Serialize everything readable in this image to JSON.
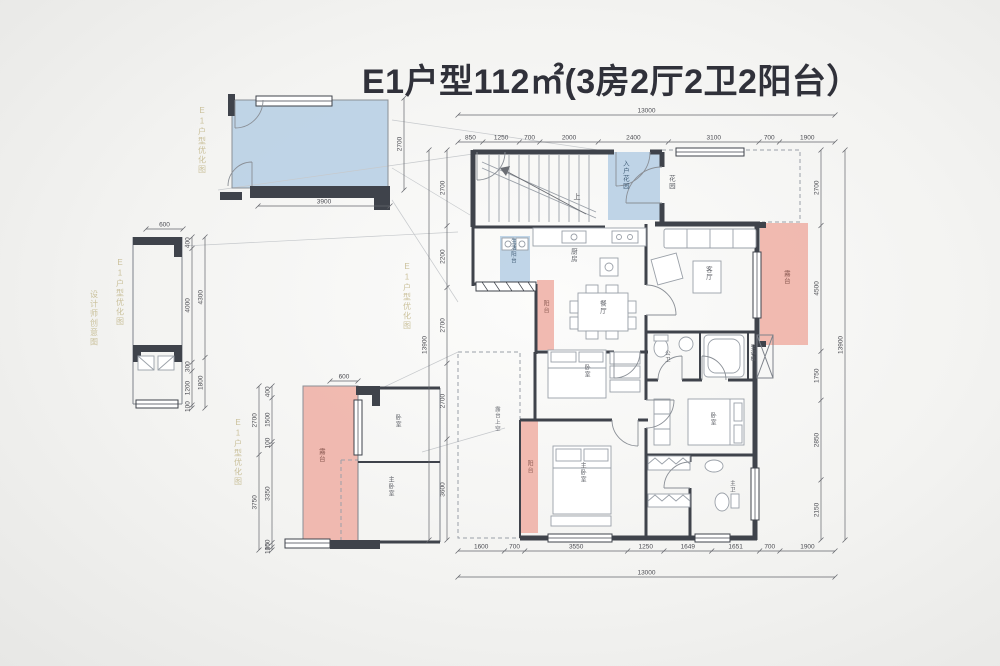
{
  "title": "E1户型112㎡(3房2厅2卫2阳台）",
  "colors": {
    "wall": "#3f434b",
    "balcony_blue": "#b5cee4",
    "terrace_pink": "#efb2a8",
    "watermark": "#c3b88c",
    "dimension_text": "#4c4d53"
  },
  "dim_chains": [
    {
      "name": "main-top",
      "orient": "h",
      "x1": 458,
      "x2": 835,
      "y": 142,
      "labels": [
        "850",
        "1250",
        "700",
        "2000",
        "2400",
        "3100",
        "700",
        "1900"
      ]
    },
    {
      "name": "main-top-total",
      "orient": "h",
      "x1": 458,
      "x2": 835,
      "y": 115,
      "labels": [
        "13000"
      ]
    },
    {
      "name": "main-bottom",
      "orient": "h",
      "x1": 458,
      "x2": 835,
      "y": 551,
      "labels": [
        "1600",
        "700",
        "3550",
        "1250",
        "1649",
        "1651",
        "700",
        "1900"
      ]
    },
    {
      "name": "main-bottom-total",
      "orient": "h",
      "x1": 458,
      "x2": 835,
      "y": 577,
      "labels": [
        "13000"
      ]
    },
    {
      "name": "main-left",
      "orient": "v",
      "x": 447,
      "y1": 150,
      "y2": 540,
      "labels": [
        "2700",
        "2200",
        "2700",
        "2700",
        "3600"
      ]
    },
    {
      "name": "main-left-total",
      "orient": "v",
      "x": 429,
      "y1": 150,
      "y2": 540,
      "labels": [
        "13900"
      ]
    },
    {
      "name": "main-right",
      "orient": "v",
      "x": 821,
      "y1": 150,
      "y2": 540,
      "labels": [
        "2700",
        "4500",
        "1750",
        "2850",
        "2150"
      ]
    },
    {
      "name": "main-right-total",
      "orient": "v",
      "x": 845,
      "y1": 150,
      "y2": 540,
      "labels": [
        "13900"
      ]
    },
    {
      "name": "detail-a-bottom",
      "orient": "h",
      "x1": 258,
      "x2": 390,
      "y": 206,
      "labels": [
        "3900"
      ]
    },
    {
      "name": "detail-a-right",
      "orient": "v",
      "x": 404,
      "y1": 98,
      "y2": 190,
      "labels": [
        "2700"
      ]
    },
    {
      "name": "detail-b-top",
      "orient": "h",
      "x1": 146,
      "x2": 183,
      "y": 229,
      "labels": [
        "600"
      ]
    },
    {
      "name": "detail-b-inner",
      "orient": "v",
      "x": 192,
      "y1": 237,
      "y2": 408,
      "labels": [
        "400",
        "4000",
        "300",
        "1200",
        "100"
      ]
    },
    {
      "name": "detail-b-outer",
      "orient": "v",
      "x": 205,
      "y1": 237,
      "y2": 408,
      "labels": [
        "4300",
        "1800"
      ]
    },
    {
      "name": "detail-c-top",
      "orient": "h",
      "x1": 330,
      "x2": 358,
      "y": 381,
      "labels": [
        "600"
      ]
    },
    {
      "name": "detail-c-inner",
      "orient": "v",
      "x": 272,
      "y1": 386,
      "y2": 550,
      "labels": [
        "400",
        "1500",
        "100",
        "3350",
        "150",
        "100"
      ]
    },
    {
      "name": "detail-c-outer",
      "orient": "v",
      "x": 259,
      "y1": 386,
      "y2": 550,
      "labels": [
        "2700",
        "3750"
      ]
    }
  ],
  "plan_labels": [
    {
      "id": "label-entry-garden",
      "text": "入户花园",
      "x": 624,
      "y": 160,
      "v": 1,
      "fs": 6.5,
      "c": "#44607a"
    },
    {
      "id": "label-garden",
      "text": "花园",
      "x": 670,
      "y": 175,
      "v": 1,
      "fs": 6.5,
      "c": "#5c5f66"
    },
    {
      "id": "label-service-balcony",
      "text": "生活阳台",
      "x": 512,
      "y": 238,
      "v": 1,
      "fs": 5.5,
      "c": "#44607a"
    },
    {
      "id": "label-kitchen",
      "text": "厨房",
      "x": 572,
      "y": 248,
      "v": 1,
      "fs": 6.5,
      "c": "#5c5f66"
    },
    {
      "id": "label-balcony-1",
      "text": "阳台",
      "x": 545,
      "y": 300,
      "v": 1,
      "fs": 6,
      "c": "#8a5a52"
    },
    {
      "id": "label-dining",
      "text": "餐厅",
      "x": 601,
      "y": 300,
      "v": 1,
      "fs": 6.5,
      "c": "#5c5f66"
    },
    {
      "id": "label-living",
      "text": "客厅",
      "x": 707,
      "y": 266,
      "v": 1,
      "fs": 6.5,
      "c": "#5c5f66"
    },
    {
      "id": "label-terrace",
      "text": "露台",
      "x": 785,
      "y": 270,
      "v": 1,
      "fs": 6.5,
      "c": "#8a5a52"
    },
    {
      "id": "label-bath-public",
      "text": "公卫",
      "x": 666,
      "y": 350,
      "v": 1,
      "fs": 5.5,
      "c": "#5c5f66"
    },
    {
      "id": "label-ac-board",
      "text": "空调板",
      "x": 752,
      "y": 344,
      "v": 1,
      "fs": 5,
      "c": "#5c5f66"
    },
    {
      "id": "label-bedroom-2",
      "text": "卧室",
      "x": 586,
      "y": 364,
      "v": 1,
      "fs": 6,
      "c": "#5c5f66"
    },
    {
      "id": "label-terrace-void",
      "text": "露台上空",
      "x": 496,
      "y": 406,
      "v": 1,
      "fs": 5.5,
      "c": "#6a6d74"
    },
    {
      "id": "label-balcony-2",
      "text": "阳台",
      "x": 529,
      "y": 460,
      "v": 1,
      "fs": 6,
      "c": "#8a5a52"
    },
    {
      "id": "label-master-bedroom",
      "text": "主卧室",
      "x": 582,
      "y": 462,
      "v": 1,
      "fs": 6,
      "c": "#5c5f66"
    },
    {
      "id": "label-bedroom-3",
      "text": "卧室",
      "x": 712,
      "y": 412,
      "v": 1,
      "fs": 6,
      "c": "#5c5f66"
    },
    {
      "id": "label-bath-master",
      "text": "主卫",
      "x": 731,
      "y": 480,
      "v": 1,
      "fs": 5.5,
      "c": "#5c5f66"
    },
    {
      "id": "label-stairs-up",
      "text": "上",
      "x": 577,
      "y": 194,
      "v": 0,
      "fs": 7,
      "c": "#4c4d53"
    },
    {
      "id": "label-detail-terrace",
      "text": "露台",
      "x": 320,
      "y": 448,
      "v": 1,
      "fs": 6.5,
      "c": "#8a5a52"
    },
    {
      "id": "label-detail-bedroom",
      "text": "卧室",
      "x": 397,
      "y": 414,
      "v": 1,
      "fs": 6,
      "c": "#5c5f66"
    },
    {
      "id": "label-detail-master",
      "text": "主卧室",
      "x": 390,
      "y": 476,
      "v": 1,
      "fs": 6,
      "c": "#5c5f66"
    }
  ],
  "watermarks": [
    {
      "id": "watermark-1",
      "text": "E1户型优化图",
      "x": 202,
      "y": 106
    },
    {
      "id": "watermark-2",
      "text": "E1户型优化图",
      "x": 120,
      "y": 258
    },
    {
      "id": "watermark-3",
      "text": "设计师创意图",
      "x": 94,
      "y": 290
    },
    {
      "id": "watermark-4",
      "text": "E1户型优化图",
      "x": 238,
      "y": 418
    },
    {
      "id": "watermark-5",
      "text": "E1户型优化图",
      "x": 407,
      "y": 262
    }
  ]
}
